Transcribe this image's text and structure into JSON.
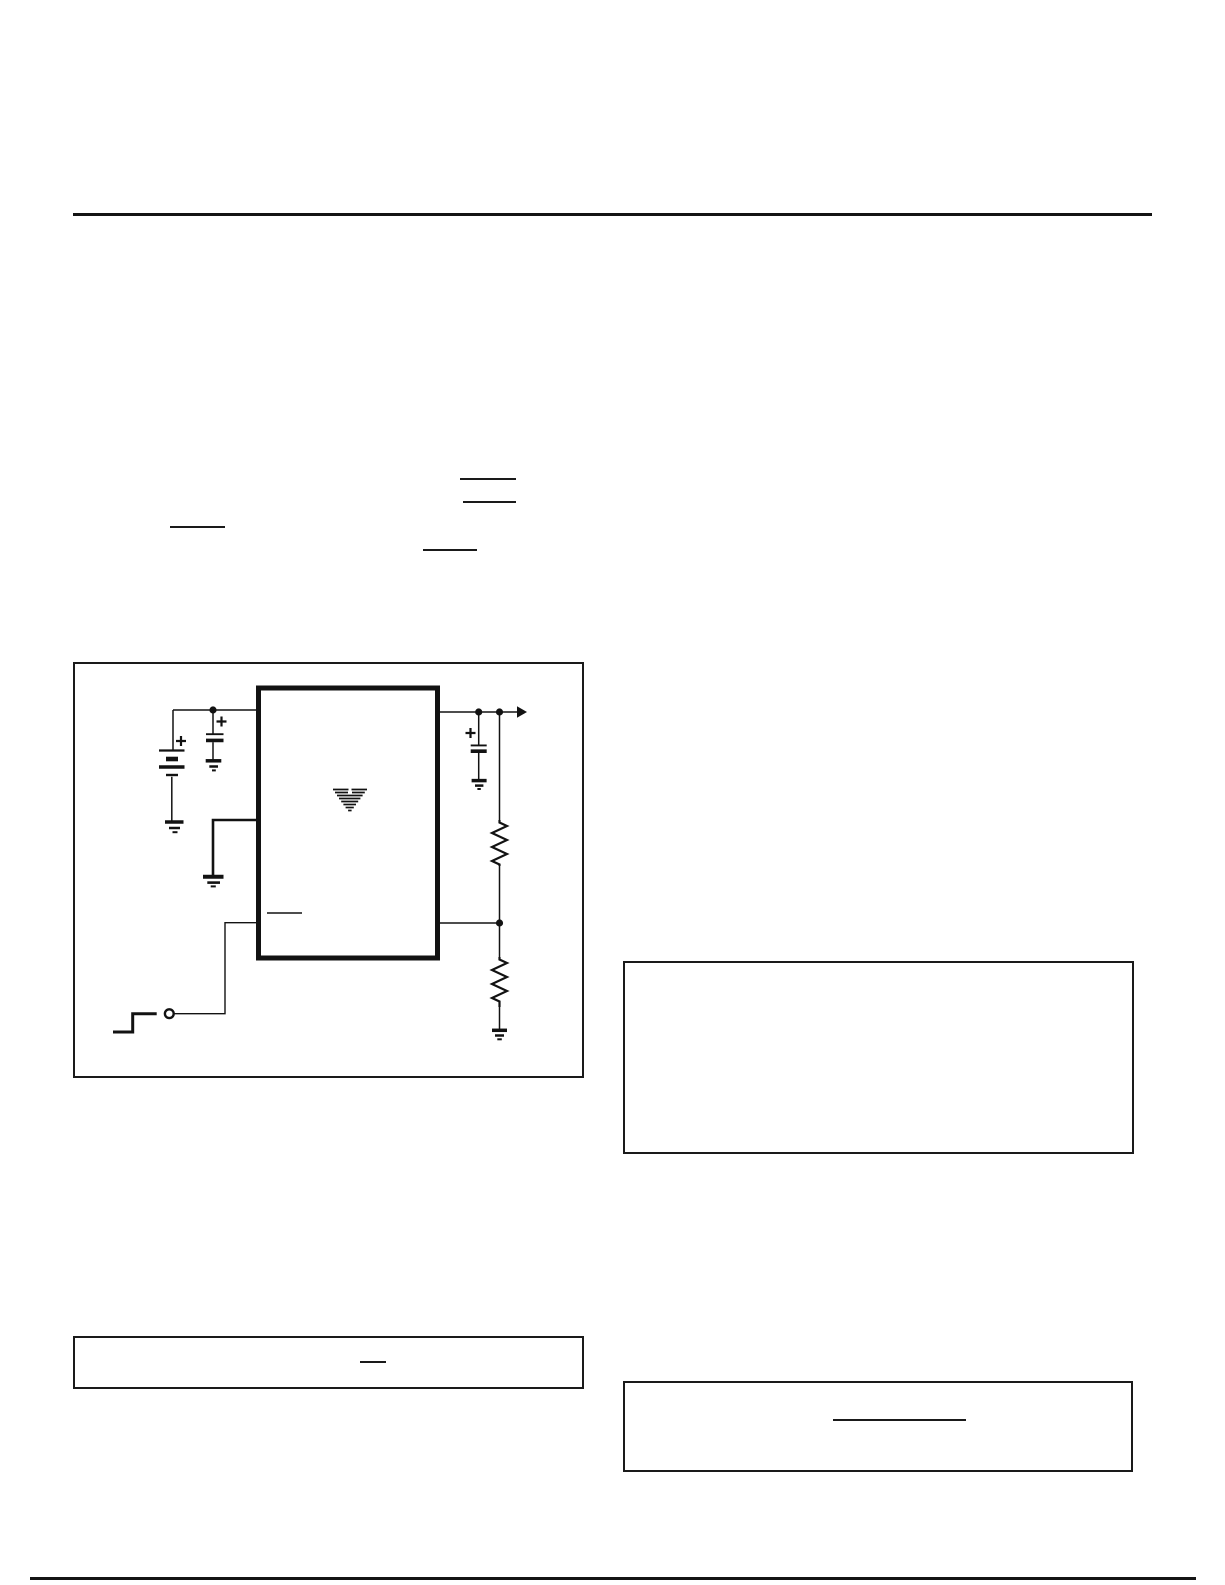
{
  "page": {
    "type": "datasheet-document-page",
    "background_color": "#ffffff",
    "line_color": "#141414",
    "visible_text": "",
    "note": "Scanned/rendered datasheet page where body text did not render; only horizontal rules, overbar strokes of formula text, one application-circuit figure and three empty outlined panels are visible."
  },
  "rules": {
    "top_divider": "full-column horizontal rule under (unrendered) page header",
    "bottom_divider": "full-width horizontal rule above (unrendered) page footer"
  },
  "overbars": {
    "count_floating": 4,
    "meaning": "overbar strokes left over from active-low signal names / fraction bars in unrendered text",
    "lower_left_panel_overbar": 1,
    "lower_right_panel_overbar": 1
  },
  "figure": {
    "name": "typical-application-circuit",
    "logo": "striped-inverted-triangle-manufacturer-logo",
    "components": [
      "battery-source-with-plus",
      "input-bypass-capacitor-polarized",
      "regulator-ic-block-thick-outline",
      "ground-symbols",
      "shutdown-pin-overbar",
      "step-input-signal-with-open-terminal",
      "output-line-with-arrow",
      "output-capacitor-polarized",
      "feedback-resistor-divider-two-resistors",
      "junction-dots"
    ]
  },
  "panels": {
    "right_panel": "empty outlined box",
    "lower_left_panel": "outlined box containing one short overbar stroke",
    "lower_right_panel": "outlined box containing one long overbar stroke"
  }
}
